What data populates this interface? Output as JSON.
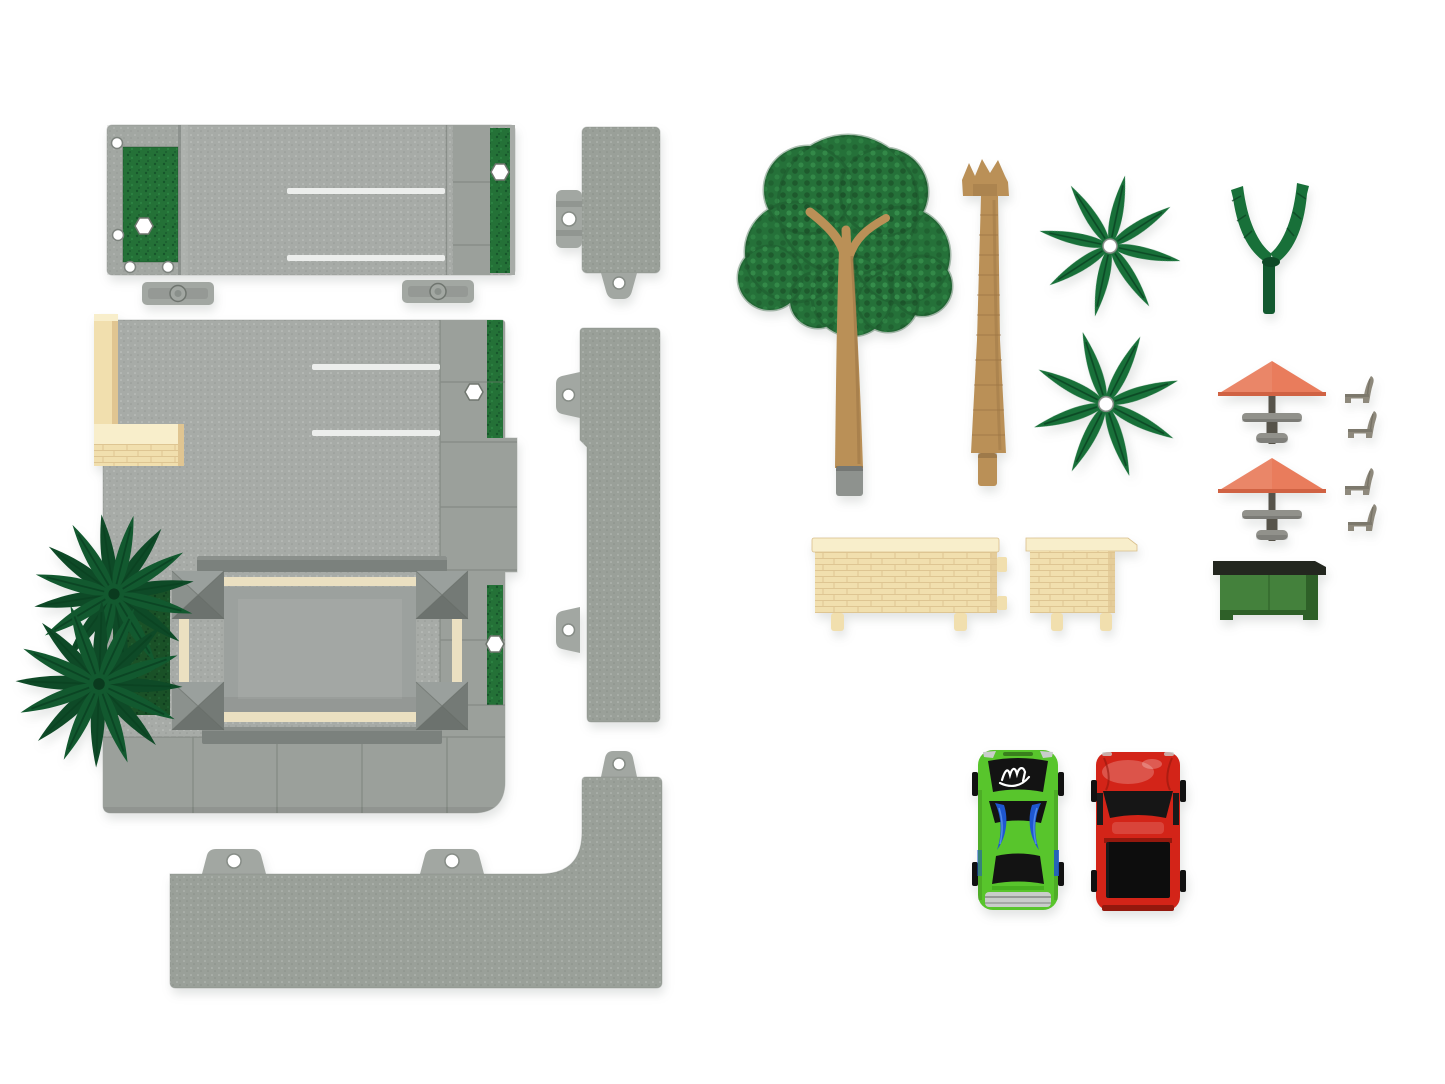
{
  "photo": {
    "kind": "product-photo-top-view",
    "background": "white seamless"
  },
  "colors": {
    "bg": "#ffffff",
    "plate": "#a7aba7",
    "plateTint": "#8f958f",
    "sidewalk": "#9ba09b",
    "curb": "#9aa099",
    "seam": "#6f756f",
    "clip": "#a2a7a2",
    "edge": "#7d837e",
    "lineWhite": "#eceeec",
    "grass": "#247137",
    "grassDark": "#16562a",
    "grassLight": "#2f8a47",
    "beige": "#f1dfae",
    "beigeLight": "#f8eecb",
    "beigeLine": "#d9be8b",
    "beigeShade": "#e0c591",
    "cream": "#ebe0c1",
    "beamDark": "#7b817d",
    "roof": "#9ca19e",
    "postTop": "#9aa09d",
    "postLeft": "#8b918d",
    "postRight": "#747a76",
    "postBottom": "#6c726e",
    "tree": "#257139",
    "treeDark": "#1a5129",
    "treeLight": "#37914e",
    "trunk": "#ba9057",
    "trunkShade": "#987244",
    "peg": "#8e928e",
    "palm": "#187039",
    "palmVein": "#0b4222",
    "palmDeep": "#12592f",
    "palmDeep2": "#0e4a27",
    "umbrella": "#e97c5c",
    "umbrellaDark": "#d06243",
    "pole": "#56534a",
    "table": "#91918b",
    "tableDark": "#7d7d77",
    "chair": "#8e897c",
    "chairDark": "#6e695d",
    "planter": "#44813c",
    "planterSide": "#2e6028",
    "planterRim": "#23271f",
    "carGreen": "#58c52c",
    "carGreenDark": "#2f9110",
    "carBlack": "#131313",
    "decalBlue": "#1e57d0",
    "decalBlueLight": "#5188ea",
    "chrome": "#c9cdca",
    "carRed": "#d32418",
    "carRedDark": "#93180d",
    "windowBlack": "#161616"
  },
  "parts": {
    "bases": [
      {
        "name": "parking-lot-plate",
        "qty": 1,
        "color": "plate"
      },
      {
        "name": "main-base-plate-with-canopy",
        "qty": 1,
        "color": "plate"
      },
      {
        "name": "curb-end-piece",
        "qty": 1,
        "color": "curb"
      },
      {
        "name": "curb-long-piece",
        "qty": 1,
        "color": "curb"
      },
      {
        "name": "curb-corner-piece",
        "qty": 1,
        "color": "curb"
      }
    ],
    "landscape": [
      {
        "name": "round-foliage-tree",
        "qty": 1,
        "color": "tree"
      },
      {
        "name": "palm-trunk",
        "qty": 1,
        "color": "trunk"
      },
      {
        "name": "palm-frond-star",
        "qty": 2,
        "color": "palm"
      },
      {
        "name": "palm-frond-cluster-on-base",
        "qty": 2,
        "color": "palmDeep"
      },
      {
        "name": "palm-sprout",
        "qty": 1,
        "color": "palm"
      }
    ],
    "furniture": [
      {
        "name": "umbrella-table-set",
        "qty": 2,
        "color": "umbrella"
      },
      {
        "name": "patio-chair",
        "qty": 4,
        "color": "chair"
      },
      {
        "name": "brick-wall-long",
        "qty": 1,
        "color": "beige"
      },
      {
        "name": "brick-wall-short",
        "qty": 1,
        "color": "beige"
      },
      {
        "name": "planter-bench",
        "qty": 1,
        "color": "planter"
      }
    ],
    "vehicles": [
      {
        "name": "sports-car-green-with-graphics",
        "qty": 1,
        "color": "carGreen"
      },
      {
        "name": "pickup-truck-red",
        "qty": 1,
        "color": "carRed"
      }
    ]
  }
}
